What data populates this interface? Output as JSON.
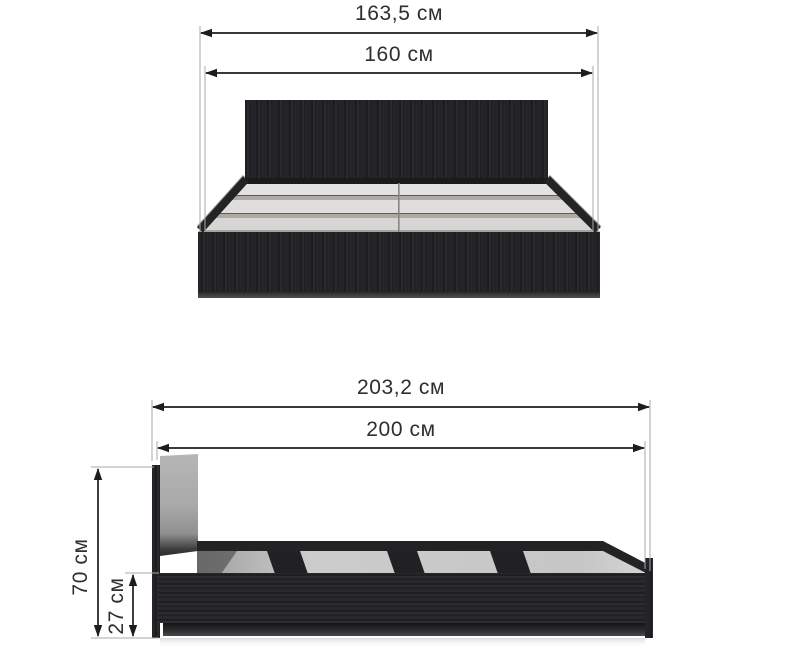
{
  "diagram": {
    "kind": "furniture-dimension-drawing",
    "unit": "см",
    "views": {
      "front": {
        "name": "front view",
        "dimensions": [
          {
            "id": "outer-width",
            "label": "163,5 см",
            "value": "163,5"
          },
          {
            "id": "inner-width",
            "label": "160 см",
            "value": "160"
          }
        ]
      },
      "side": {
        "name": "side view",
        "dimensions": [
          {
            "id": "outer-length",
            "label": "203,2 см",
            "value": "203,2"
          },
          {
            "id": "inner-length",
            "label": "200 см",
            "value": "200"
          },
          {
            "id": "headboard-height",
            "label": "70 см",
            "value": "70"
          },
          {
            "id": "base-height",
            "label": "27 см",
            "value": "27"
          }
        ]
      }
    }
  },
  "colors": {
    "background": "#ffffff",
    "dimension_line": "#1d1d1d",
    "extension_line": "#a8a8a8",
    "dimension_text": "#2e2e2e",
    "wood_dark": "#232326",
    "headboard_back_panel": "#aaaaaa",
    "slat_light": "#dedede",
    "slat_edge": "#afaba4",
    "interior_floor": "#c8c8c8"
  }
}
